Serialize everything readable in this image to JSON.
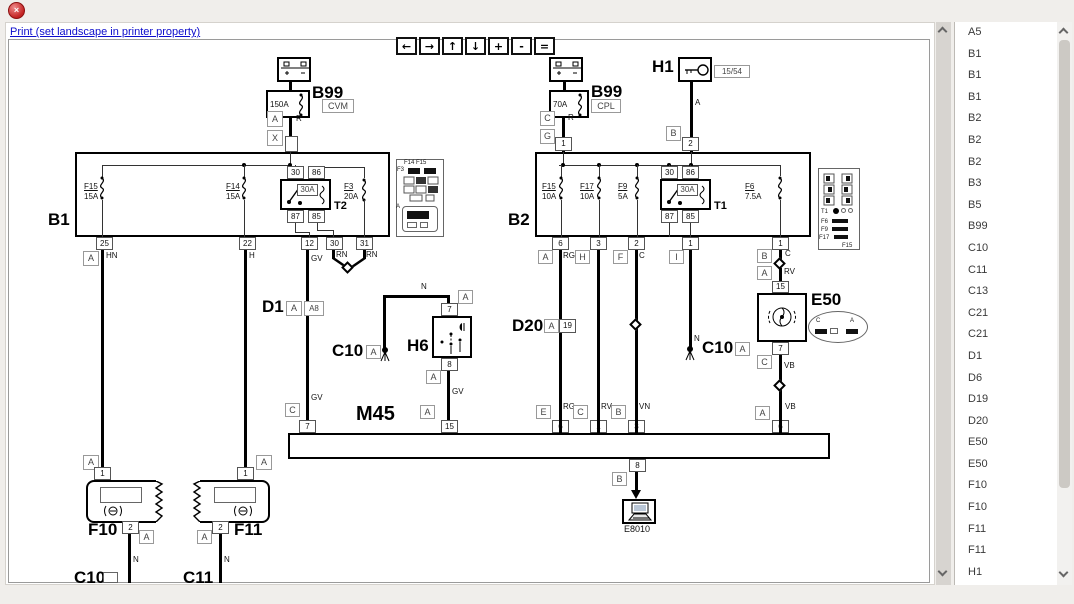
{
  "chrome": {
    "close_icon": "×",
    "print_link": "Print (set landscape in printer property)"
  },
  "toolbar": {
    "buttons": [
      "←",
      "→",
      "↑",
      "↓",
      "+",
      "-",
      "="
    ]
  },
  "sidebar": {
    "items": [
      "A5",
      "B1",
      "B1",
      "B1",
      "B2",
      "B2",
      "B2",
      "B3",
      "B5",
      "B99",
      "C10",
      "C11",
      "C13",
      "C21",
      "C21",
      "D1",
      "D6",
      "D19",
      "D20",
      "E50",
      "E50",
      "F10",
      "F10",
      "F11",
      "F11",
      "H1"
    ]
  },
  "components": {
    "b1": "B1",
    "b2": "B2",
    "b99": "B99",
    "cvm": "CVM",
    "cpl": "CPL",
    "h1": "H1",
    "ign_tag": "15/54",
    "h6": "H6",
    "c10": "C10",
    "c11": "C11",
    "d1": "D1",
    "d20": "D20",
    "m45": "M45",
    "e50": "E50",
    "e8010": "E8010",
    "f10": "F10",
    "f11": "F11",
    "t1": "T1",
    "t2": "T2"
  },
  "fuses": {
    "megafuse_left": "150A",
    "megafuse_right": "70A",
    "relay_fuse": "30A",
    "f15_b1": {
      "name": "F15",
      "amp": "15A"
    },
    "f14_b1": {
      "name": "F14",
      "amp": "15A"
    },
    "f3_b1": {
      "name": "F3",
      "amp": "20A"
    },
    "f15_b2": {
      "name": "F15",
      "amp": "10A"
    },
    "f17_b2": {
      "name": "F17",
      "amp": "10A"
    },
    "f9_b2": {
      "name": "F9",
      "amp": "5A"
    },
    "f6_b2": {
      "name": "F6",
      "amp": "7.5A"
    }
  },
  "pins": {
    "p1": "1",
    "p2": "2",
    "p3": "3",
    "p6": "6",
    "p7": "7",
    "p8": "8",
    "p12": "12",
    "p15": "15",
    "p19": "19",
    "p22": "22",
    "p25": "25",
    "p30": "30",
    "p31": "31",
    "p85": "85",
    "p86": "86",
    "p87": "87"
  },
  "tags": {
    "a": "A",
    "a8": "A8",
    "b": "B",
    "c": "C",
    "e": "E",
    "f": "F",
    "g": "G",
    "h": "H",
    "i": "I",
    "x": "X"
  },
  "wires": {
    "r": "R",
    "a": "A",
    "n": "N",
    "hn": "HN",
    "h": "H",
    "gv": "GV",
    "rn": "RN",
    "rg": "RG",
    "rv": "RV",
    "vn": "VN",
    "c": "C",
    "vb": "VB"
  },
  "insets": {
    "b1_caption": "F14 F15",
    "b1_f3": "F3",
    "b1_conn": "A",
    "b2_t1": "T1",
    "b2_f6": "F6",
    "b2_f9": "F9",
    "b2_f17": "F17",
    "b2_f15": "F15",
    "e50_c": "C",
    "e50_a": "A"
  }
}
